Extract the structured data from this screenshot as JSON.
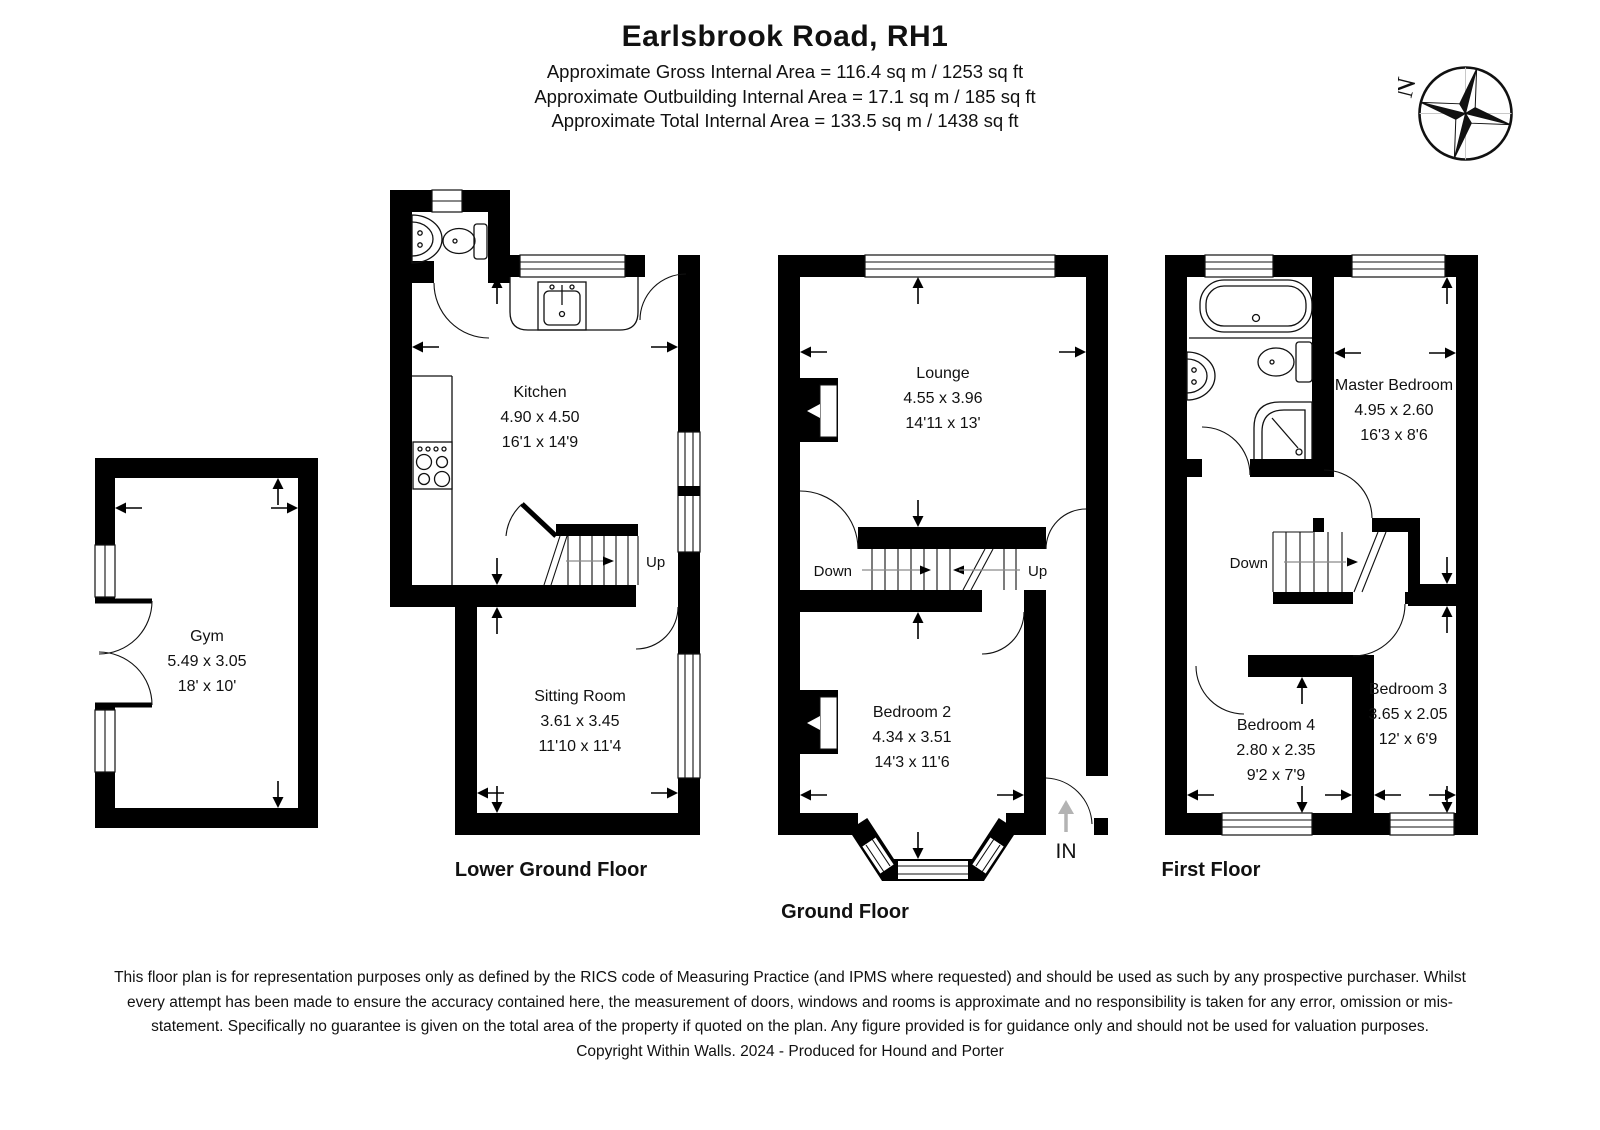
{
  "header": {
    "title": "Earlsbrook Road, RH1",
    "area_lines": [
      "Approximate Gross Internal Area = 116.4 sq m / 1253 sq ft",
      "Approximate Outbuilding Internal Area = 17.1 sq m / 185 sq ft",
      "Approximate Total Internal Area = 133.5 sq m / 1438 sq ft"
    ]
  },
  "compass": {
    "north_label": "N"
  },
  "rooms": {
    "gym": {
      "name": "Gym",
      "dim_m": "5.49 x 3.05",
      "dim_ft": "18' x 10'"
    },
    "kitchen": {
      "name": "Kitchen",
      "dim_m": "4.90 x 4.50",
      "dim_ft": "16'1 x 14'9"
    },
    "sitting_room": {
      "name": "Sitting Room",
      "dim_m": "3.61 x 3.45",
      "dim_ft": "11'10 x 11'4"
    },
    "lounge": {
      "name": "Lounge",
      "dim_m": "4.55 x 3.96",
      "dim_ft": "14'11 x 13'"
    },
    "bedroom2": {
      "name": "Bedroom 2",
      "dim_m": "4.34 x 3.51",
      "dim_ft": "14'3 x 11'6"
    },
    "master_bedroom": {
      "name": "Master Bedroom",
      "dim_m": "4.95 x 2.60",
      "dim_ft": "16'3 x 8'6"
    },
    "bedroom4": {
      "name": "Bedroom 4",
      "dim_m": "2.80 x 2.35",
      "dim_ft": "9'2 x 7'9"
    },
    "bedroom3": {
      "name": "Bedroom 3",
      "dim_m": "3.65 x 2.05",
      "dim_ft": "12' x 6'9"
    }
  },
  "floor_labels": {
    "lower_ground": "Lower Ground Floor",
    "ground": "Ground Floor",
    "first": "First Floor"
  },
  "stair_labels": {
    "lgf_up": "Up",
    "gf_down": "Down",
    "gf_up": "Up",
    "ff_down": "Down"
  },
  "entrance": {
    "label": "IN"
  },
  "footer": {
    "disclaimer": "This floor plan is for representation purposes only as defined by the RICS code of Measuring Practice (and IPMS where requested) and should be used as such by any prospective purchaser. Whilst every attempt has been made to ensure the accuracy contained here, the measurement of doors, windows and rooms is approximate and no responsibility is taken for any error, omission or mis-statement. Specifically no guarantee is given on the total area of the property if quoted on the plan. Any figure provided is for guidance only and should not be used for valuation purposes.",
    "copyright": "Copyright Within Walls. 2024 - Produced for Hound and Porter"
  },
  "colors": {
    "wall": "#000000",
    "background": "#ffffff",
    "stair_line": "#8a8a8a",
    "in_arrow": "#b3b3b3"
  }
}
